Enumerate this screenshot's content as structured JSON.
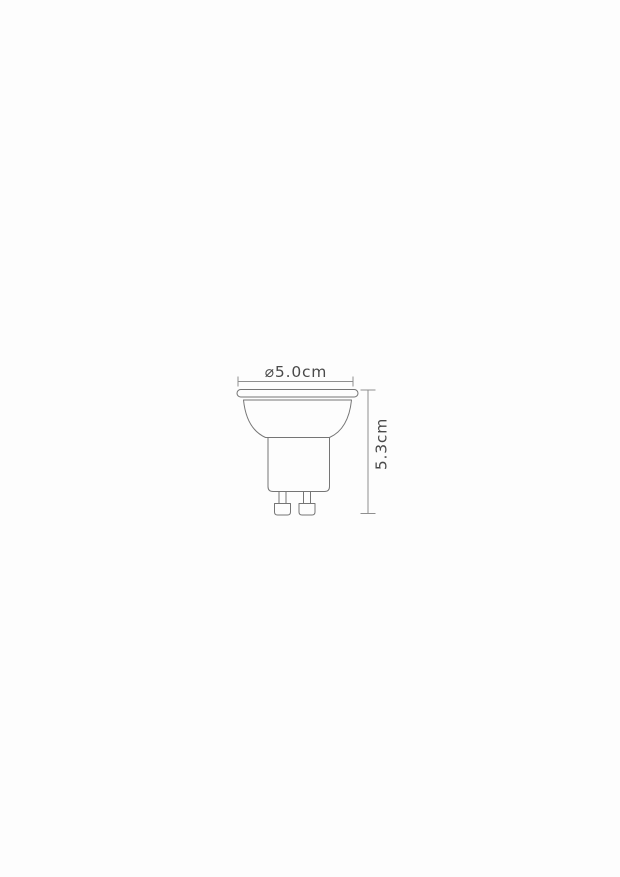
{
  "page": {
    "background_color": "#fdfdfd"
  },
  "diagram": {
    "kind": "bulb-dimension-drawing",
    "width_dimension": {
      "label": "⌀5.0cm",
      "value_cm": 5.0,
      "symbol": "diameter"
    },
    "height_dimension": {
      "label": "5.3cm",
      "value_cm": 5.3
    },
    "colors": {
      "outline": "#757575",
      "dimension_lines": "#8f8f8f",
      "label_text": "#4a4a4a"
    }
  }
}
